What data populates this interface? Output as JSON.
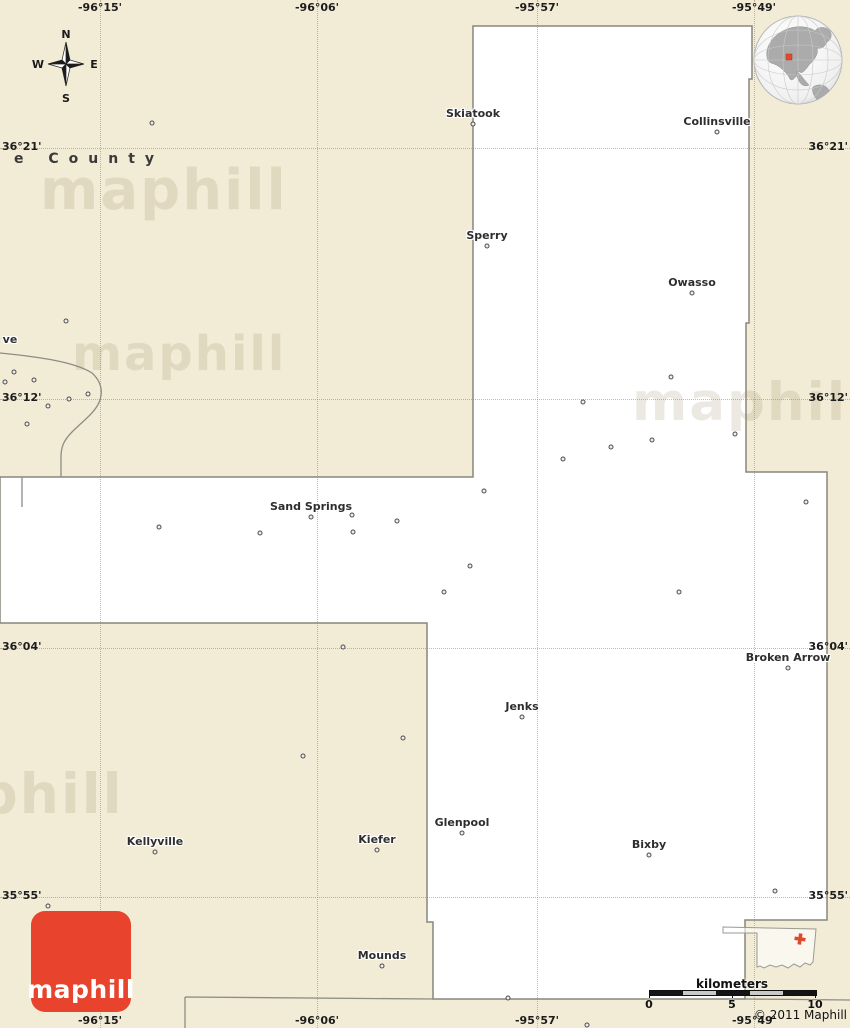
{
  "labels": {
    "county_partial": "e County",
    "city_partial_left": "ve"
  },
  "watermark": {
    "text": "maphill"
  },
  "compass": {
    "n": "N",
    "s": "S",
    "e": "E",
    "w": "W"
  },
  "grid": {
    "vertical": [
      {
        "label": "-96°15'",
        "x": 100
      },
      {
        "label": "-96°06'",
        "x": 317
      },
      {
        "label": "-95°57'",
        "x": 537
      },
      {
        "label": "-95°49'",
        "x": 754
      }
    ],
    "horizontal": [
      {
        "label": "36°21'",
        "y": 148
      },
      {
        "label": "36°12'",
        "y": 399
      },
      {
        "label": "36°04'",
        "y": 648
      },
      {
        "label": "35°55'",
        "y": 897
      }
    ]
  },
  "cities": [
    {
      "name": "Skiatook",
      "x": 473,
      "y": 124
    },
    {
      "name": "Collinsville",
      "x": 717,
      "y": 132
    },
    {
      "name": "Sperry",
      "x": 487,
      "y": 246
    },
    {
      "name": "Owasso",
      "x": 692,
      "y": 293
    },
    {
      "name": "Sand Springs",
      "x": 311,
      "y": 517
    },
    {
      "name": "Broken Arrow",
      "x": 788,
      "y": 668
    },
    {
      "name": "Jenks",
      "x": 522,
      "y": 717
    },
    {
      "name": "Glenpool",
      "x": 462,
      "y": 833
    },
    {
      "name": "Kiefer",
      "x": 377,
      "y": 850
    },
    {
      "name": "Kellyville",
      "x": 155,
      "y": 852
    },
    {
      "name": "Bixby",
      "x": 649,
      "y": 855
    },
    {
      "name": "Mounds",
      "x": 382,
      "y": 966
    }
  ],
  "poi_dots": [
    [
      152,
      123
    ],
    [
      66,
      321
    ],
    [
      14,
      372
    ],
    [
      5,
      382
    ],
    [
      34,
      380
    ],
    [
      88,
      394
    ],
    [
      69,
      399
    ],
    [
      48,
      406
    ],
    [
      27,
      424
    ],
    [
      583,
      402
    ],
    [
      671,
      377
    ],
    [
      652,
      440
    ],
    [
      611,
      447
    ],
    [
      563,
      459
    ],
    [
      735,
      434
    ],
    [
      806,
      502
    ],
    [
      484,
      491
    ],
    [
      159,
      527
    ],
    [
      260,
      533
    ],
    [
      352,
      515
    ],
    [
      353,
      532
    ],
    [
      397,
      521
    ],
    [
      470,
      566
    ],
    [
      444,
      592
    ],
    [
      679,
      592
    ],
    [
      343,
      647
    ],
    [
      403,
      738
    ],
    [
      303,
      756
    ],
    [
      775,
      891
    ],
    [
      48,
      906
    ],
    [
      508,
      998
    ],
    [
      587,
      1025
    ]
  ],
  "scalebar": {
    "title": "kilometers",
    "ticks": [
      "0",
      "5",
      "10"
    ]
  },
  "logo": {
    "text": "maphill"
  },
  "copyright": "© 2011 Maphill",
  "colors": {
    "land_outside_county": "#f2ebd6",
    "county_fill": "#ffffff",
    "boundary_line": "#87877d",
    "grid_dotted": "#978a62",
    "logo_red": "#e8432c",
    "locator_marker_red": "#de4a2e",
    "scalebar_black": "#141414",
    "scalebar_silver": "#c9c9c9"
  }
}
